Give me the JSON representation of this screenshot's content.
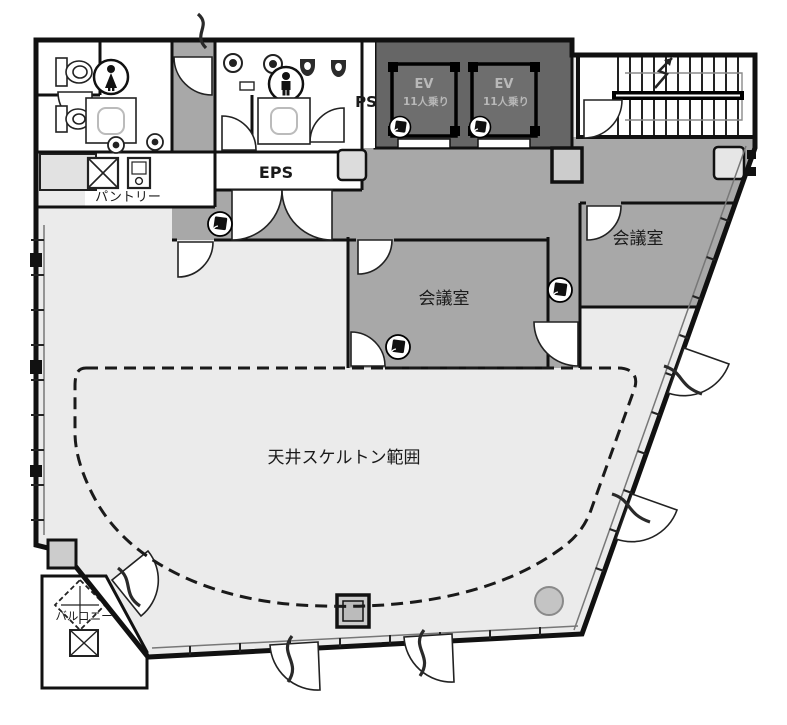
{
  "floorplan": {
    "labels": {
      "ps": "PS",
      "eps": "EPS",
      "pantry": "パントリー",
      "meeting_room_center": "会議室",
      "meeting_room_right": "会議室",
      "ceiling_skeleton_area": "天井スケルトン範囲",
      "balcony": "バルコニー"
    },
    "elevators": {
      "count": 2,
      "label": "EV",
      "capacity": "11人乗り"
    },
    "colors": {
      "wall": "#1a1a1a",
      "corridor": "#a8a8a8",
      "meeting_room": "#a8a8a8",
      "elevator_zone": "#666666",
      "office_area": "#ebebeb",
      "background": "#ffffff"
    }
  }
}
